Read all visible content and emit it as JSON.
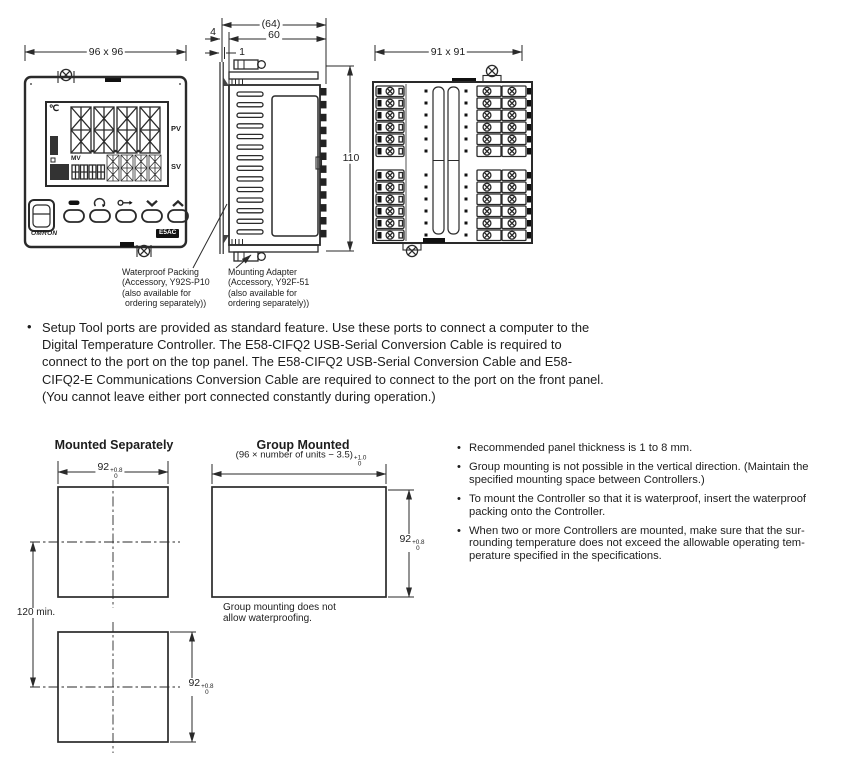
{
  "colors": {
    "ink": "#2a2a2a",
    "paper": "#ffffff"
  },
  "views": {
    "front": {
      "dim": "96 x 96",
      "deg_c": "℃",
      "pv": "PV",
      "sv": "SV",
      "mv": "MV",
      "brand": "OMRON",
      "model": "E5AC",
      "key_icons": [
        "level-key",
        "mode-key",
        "shift-key",
        "down-key",
        "up-key"
      ]
    },
    "side": {
      "dim_overall": "(64)",
      "dim_depth": "60",
      "dim_bezel": "4",
      "dim_packing": "1",
      "dim_height": "110"
    },
    "rear": {
      "dim": "91 x 91"
    },
    "callout_waterproof": {
      "lines": [
        "Waterproof Packing",
        "(Accessory, Y92S-P10",
        "(also available for",
        "ordering separately))"
      ]
    },
    "callout_adapter": {
      "lines": [
        "Mounting Adapter",
        "(Accessory, Y92F-51",
        "(also available for",
        "ordering separately))"
      ]
    }
  },
  "setup_note": {
    "lines": [
      "Setup Tool ports are provided as standard feature. Use these ports to connect a computer to the",
      "Digital Temperature Controller. The E58-CIFQ2 USB-Serial Conversion Cable is required to",
      "connect to the port on the top panel. The E58-CIFQ2 USB-Serial Conversion Cable and E58-",
      "CIFQ2-E Communications Conversion Cable are required to connect to the port on the front panel.",
      "(You cannot leave either port connected constantly during operation.)"
    ]
  },
  "cutout": {
    "separate": {
      "title": "Mounted Separately",
      "spacing": "120 min."
    },
    "group": {
      "title": "Group Mounted",
      "formula": "(96 × number of units − 3.5)",
      "tol_plus": "+1.0",
      "tol_zero": "0",
      "note_lines": [
        "Group mounting does not",
        "allow waterproofing."
      ]
    },
    "dim92": {
      "value": "92",
      "tol_plus": "+0.8",
      "tol_zero": "0"
    }
  },
  "mounting_notes": [
    {
      "lines": [
        "Recommended panel thickness is 1 to 8 mm."
      ]
    },
    {
      "lines": [
        "Group mounting is not possible in the vertical direction. (Maintain the",
        "specified mounting space between Controllers.)"
      ]
    },
    {
      "lines": [
        "To mount the Controller so that it is waterproof, insert the waterproof",
        "packing onto the Controller."
      ]
    },
    {
      "lines": [
        "When two or more Controllers are mounted, make sure that the sur-",
        "rounding temperature does not exceed the allowable operating tem-",
        "perature specified in the specifications."
      ]
    }
  ]
}
